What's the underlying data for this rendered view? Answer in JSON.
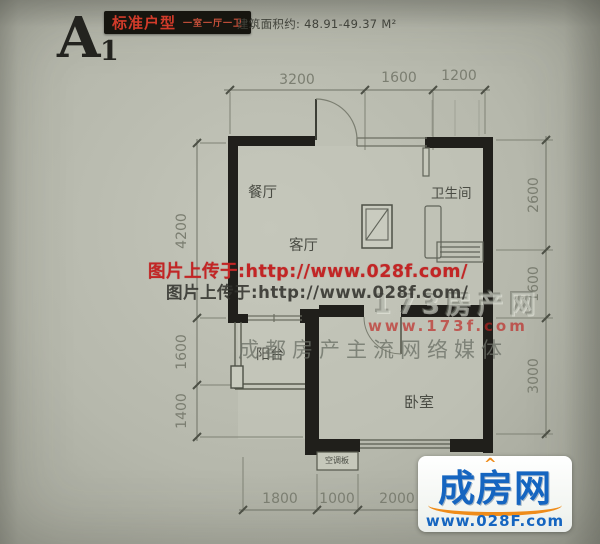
{
  "header": {
    "unit_letter": "A",
    "unit_subscript": "1",
    "badge_title": "标准户型",
    "badge_subtitle": "一室一厅一卫",
    "area_text": "建筑面积约: 48.91-49.37 M²"
  },
  "plan": {
    "rooms": {
      "dining": "餐厅",
      "bath": "卫生间",
      "living": "客厅",
      "balcony": "阳台",
      "bedroom": "卧室",
      "ac_panel": "空调板"
    },
    "dims": {
      "top": [
        "3200",
        "1600",
        "1200"
      ],
      "right": [
        "2600",
        "1600",
        "3000"
      ],
      "left": [
        "4200",
        "1600",
        "1400"
      ],
      "bottom": [
        "1800",
        "1000",
        "2000"
      ]
    }
  },
  "watermarks": {
    "red_url_line": "图片上传于:http://www.028f.com/",
    "dark_url_line": "图片上传于:http://www.028f.com/",
    "embossed_site": "173房产网",
    "embossed_url": "www.173f.com",
    "slogan": "成都房产主流网络媒体"
  },
  "logo": {
    "caret": "^",
    "name": "成房网",
    "url": "www.028F.com"
  },
  "colors": {
    "wall": "#201f1b",
    "badge_red": "#d23b2a",
    "watermark_red": "#c22525",
    "logo_blue": "#1565c0",
    "logo_orange": "#ef8c1a",
    "paper": "#b6b8ac"
  }
}
